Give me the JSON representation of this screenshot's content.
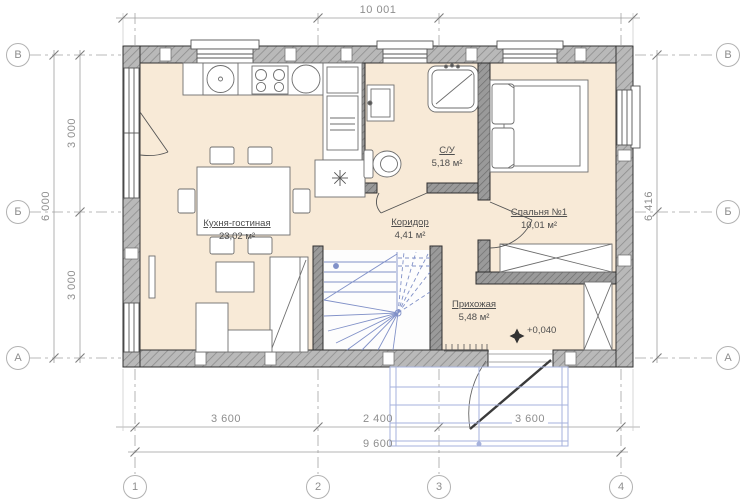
{
  "axes": {
    "rows": [
      "В",
      "Б",
      "А"
    ],
    "cols": [
      "1",
      "2",
      "3",
      "4"
    ]
  },
  "dimensions": {
    "top_total": "10 001",
    "left_outer": "6 000",
    "left_segments": [
      "3 000",
      "3 000"
    ],
    "right_total": "6 416",
    "bottom_segments": [
      "3 600",
      "2 400",
      "3 600"
    ],
    "bottom_total": "9 600"
  },
  "rooms": [
    {
      "name": "Кухня-гостиная",
      "area": "23,02 м²"
    },
    {
      "name": "С/У",
      "area": "5,18 м²"
    },
    {
      "name": "Коридор",
      "area": "4,41 м²"
    },
    {
      "name": "Спальня №1",
      "area": "10,01 м²"
    },
    {
      "name": "Прихожая",
      "area": "5,48 м²"
    }
  ],
  "marks": {
    "elevation": "+0,040"
  },
  "colors": {
    "floor": "#f8ead7",
    "wall_hatch": "#b5b5b5",
    "wall_line": "#333333",
    "stairs_blue": "#8191c8",
    "porch_blue": "#a6b2dc",
    "dimension_gray": "#8e8e8e"
  }
}
